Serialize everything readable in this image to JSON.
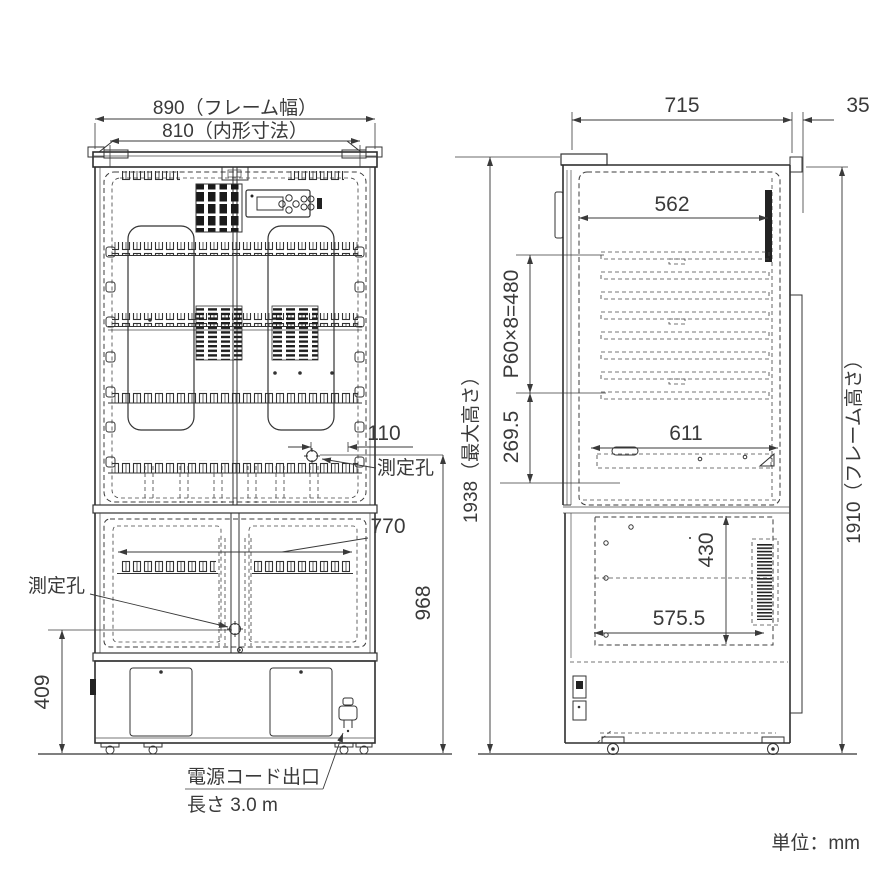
{
  "meta": {
    "unit_note": "単位：mm"
  },
  "front_view": {
    "dimensions": {
      "frame_width": "890（フレーム幅）",
      "inner_width": "810（内形寸法）",
      "hole_offset": "110",
      "lower_opening_width": "770",
      "upper_hole_height": "968",
      "base_height": "409"
    },
    "labels": {
      "measurement_hole_upper": "測定孔",
      "measurement_hole_lower": "測定孔",
      "power_cord_exit": "電源コード出口",
      "power_cord_length": "長さ 3.0 m"
    }
  },
  "side_view": {
    "dimensions": {
      "depth": "715",
      "rear_clearance": "35",
      "inner_depth_top": "562",
      "shelf_pitch": "P60×8=480",
      "lower_clearance": "269.5",
      "shelf_depth": "611",
      "machine_room_height": "430",
      "machine_room_depth": "575.5",
      "max_height": "1938（最大高さ）",
      "frame_height": "1910（フレーム高さ）"
    }
  },
  "colors": {
    "line": "#333333",
    "text": "#3a3a3a",
    "background": "#ffffff"
  }
}
